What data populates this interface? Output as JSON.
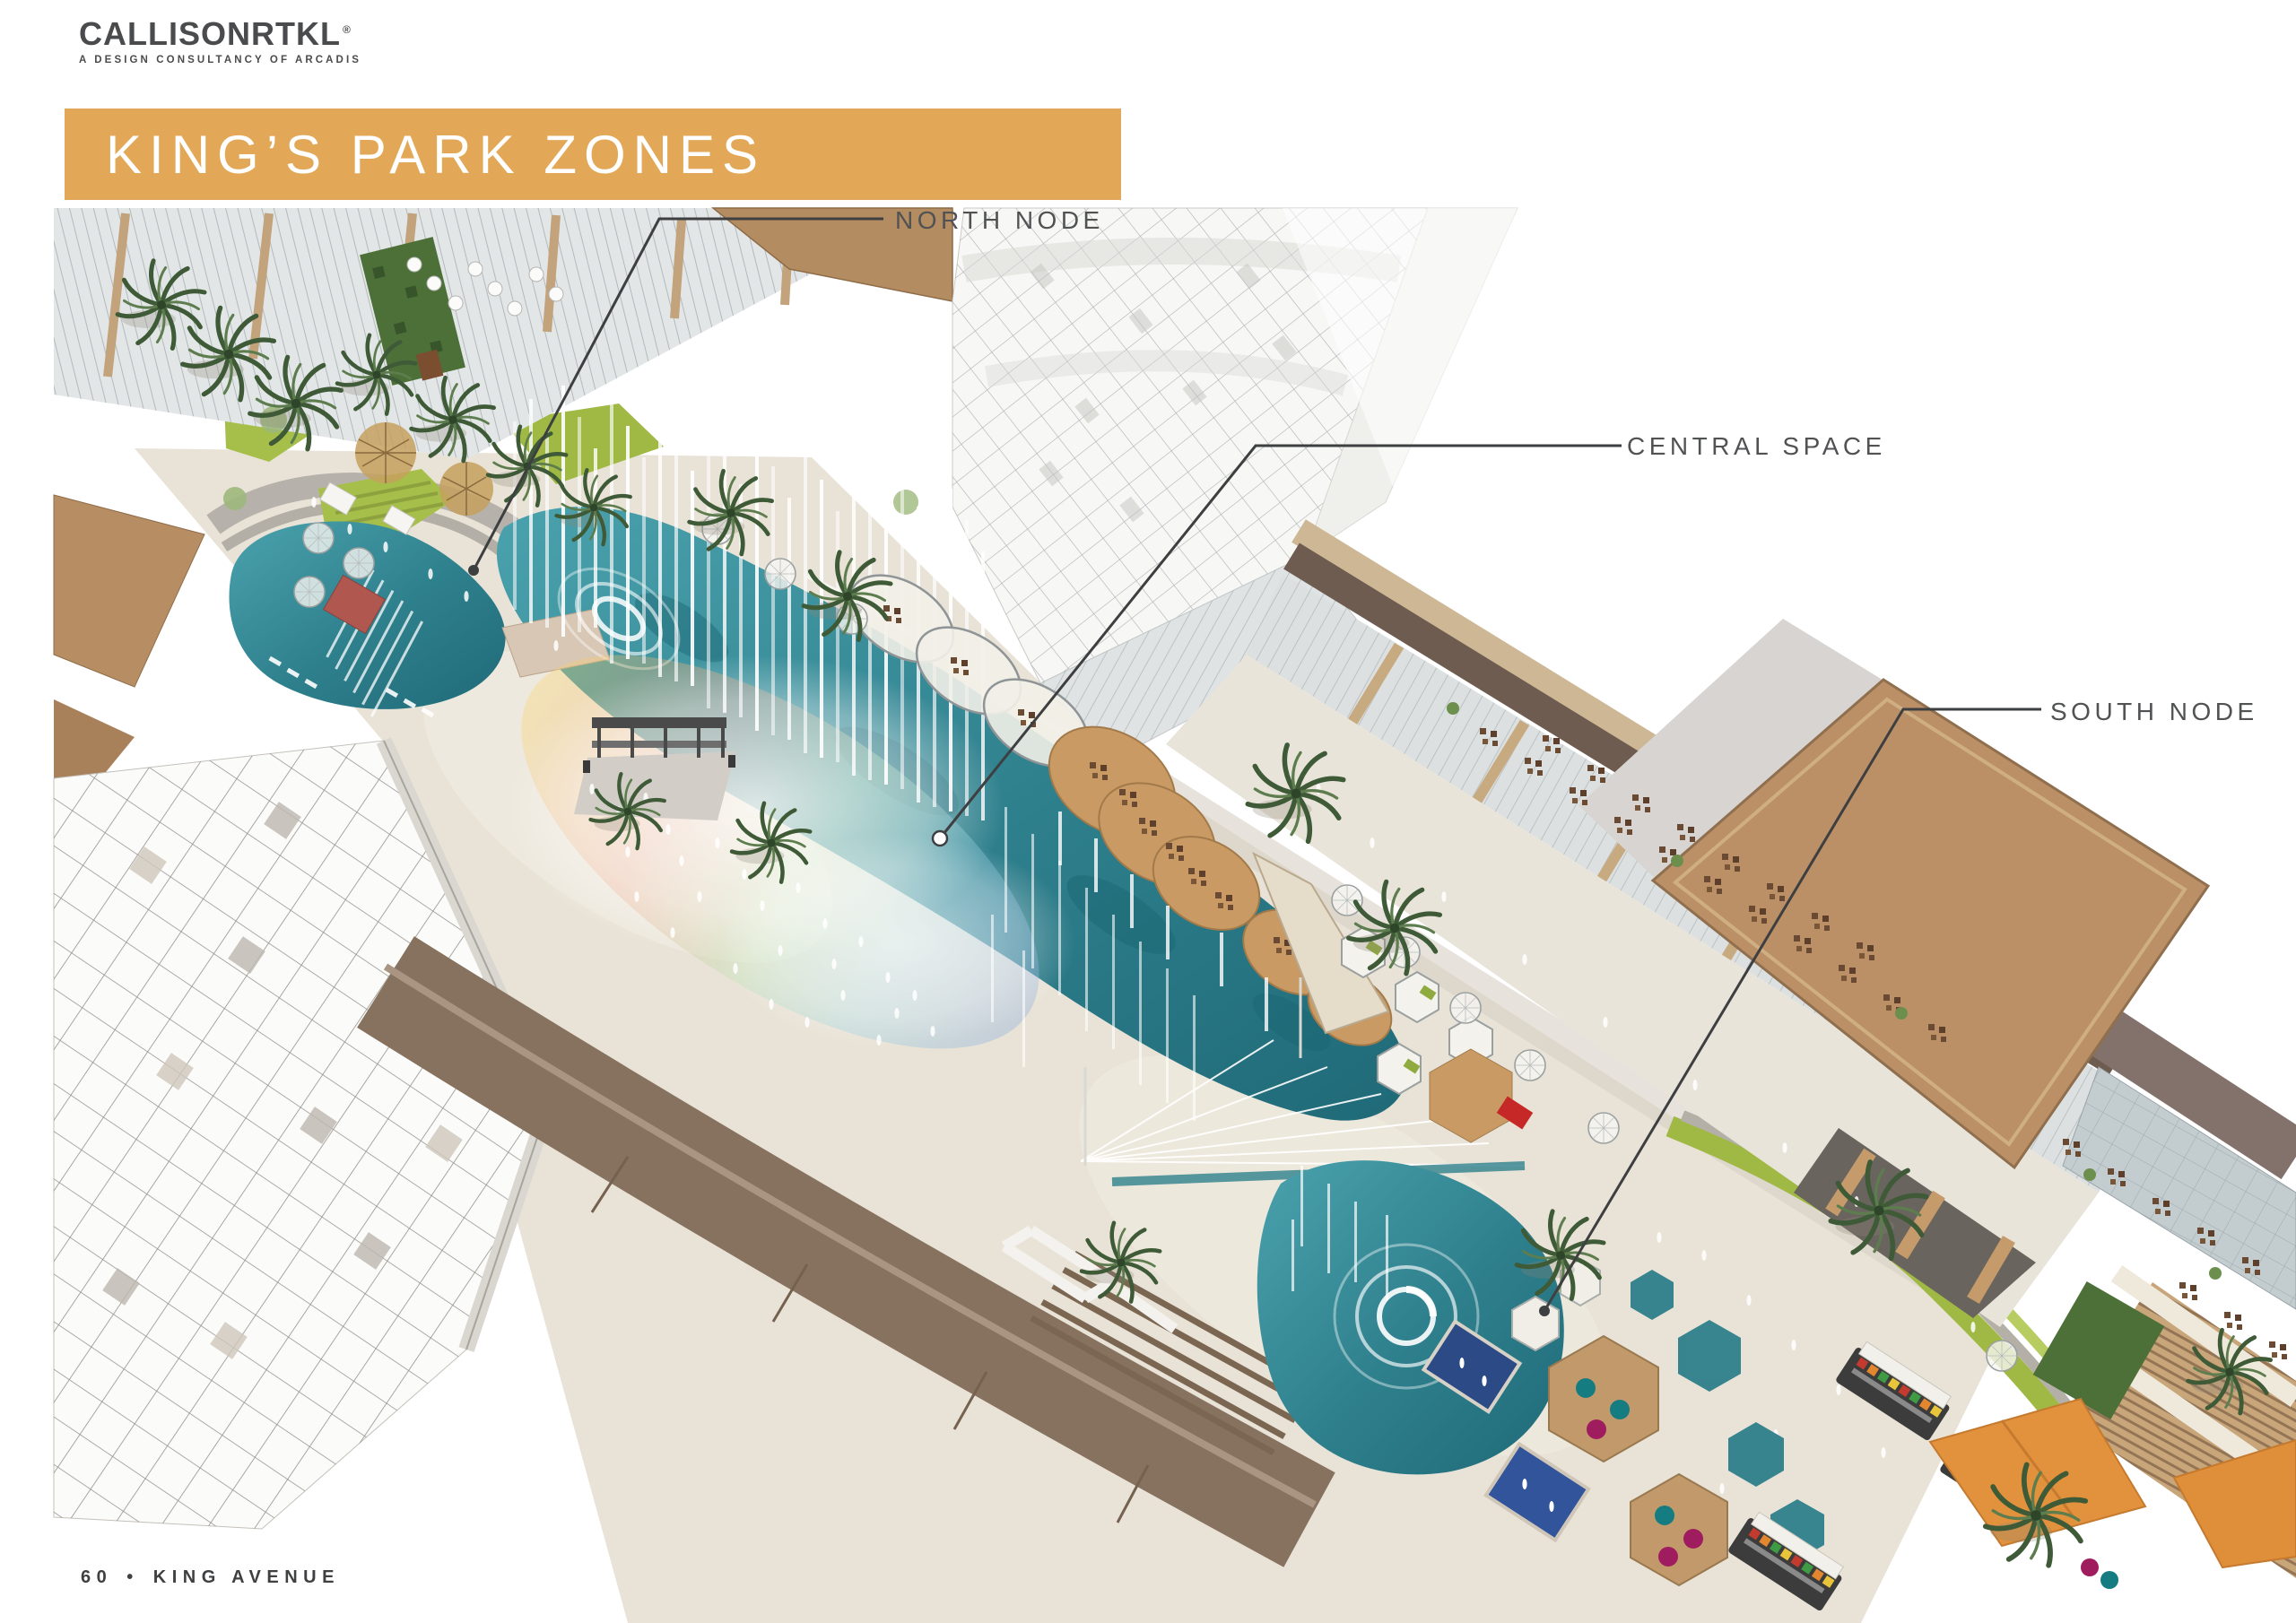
{
  "brand": {
    "name": "CALLISONRTKL",
    "registered": "®",
    "tagline": "A DESIGN CONSULTANCY OF ARCADIS"
  },
  "title": {
    "text": "KING’S PARK ZONES"
  },
  "annotations": {
    "north": {
      "label": "NORTH NODE"
    },
    "central": {
      "label": "CENTRAL SPACE"
    },
    "south": {
      "label": "SOUTH NODE"
    }
  },
  "footer": {
    "page_number": "60",
    "bullet": "•",
    "document_title": "KING AVENUE"
  },
  "colors": {
    "banner_gold": "#E2A857",
    "logo_gray": "#4A4B4D",
    "label_gray": "#515254",
    "footer_gray": "#3F4042",
    "leader_line": "#3E3F41",
    "pool_teal": "#2E7F8C",
    "pool_teal_dark": "#1F6472",
    "pool_navy": "#2B4A86",
    "roof_tan": "#BB9067",
    "roof_taupe": "#6F5C50",
    "lawn_green": "#A6BF4A",
    "palm_green": "#3E5A37",
    "sail_orange": "#E2923D",
    "paving_beige": "#E9E3D7",
    "glass_gray": "#DCE0E0",
    "accent_red": "#C62828",
    "beanbag_magenta": "#9F1D5F",
    "beanbag_teal": "#157C82"
  }
}
